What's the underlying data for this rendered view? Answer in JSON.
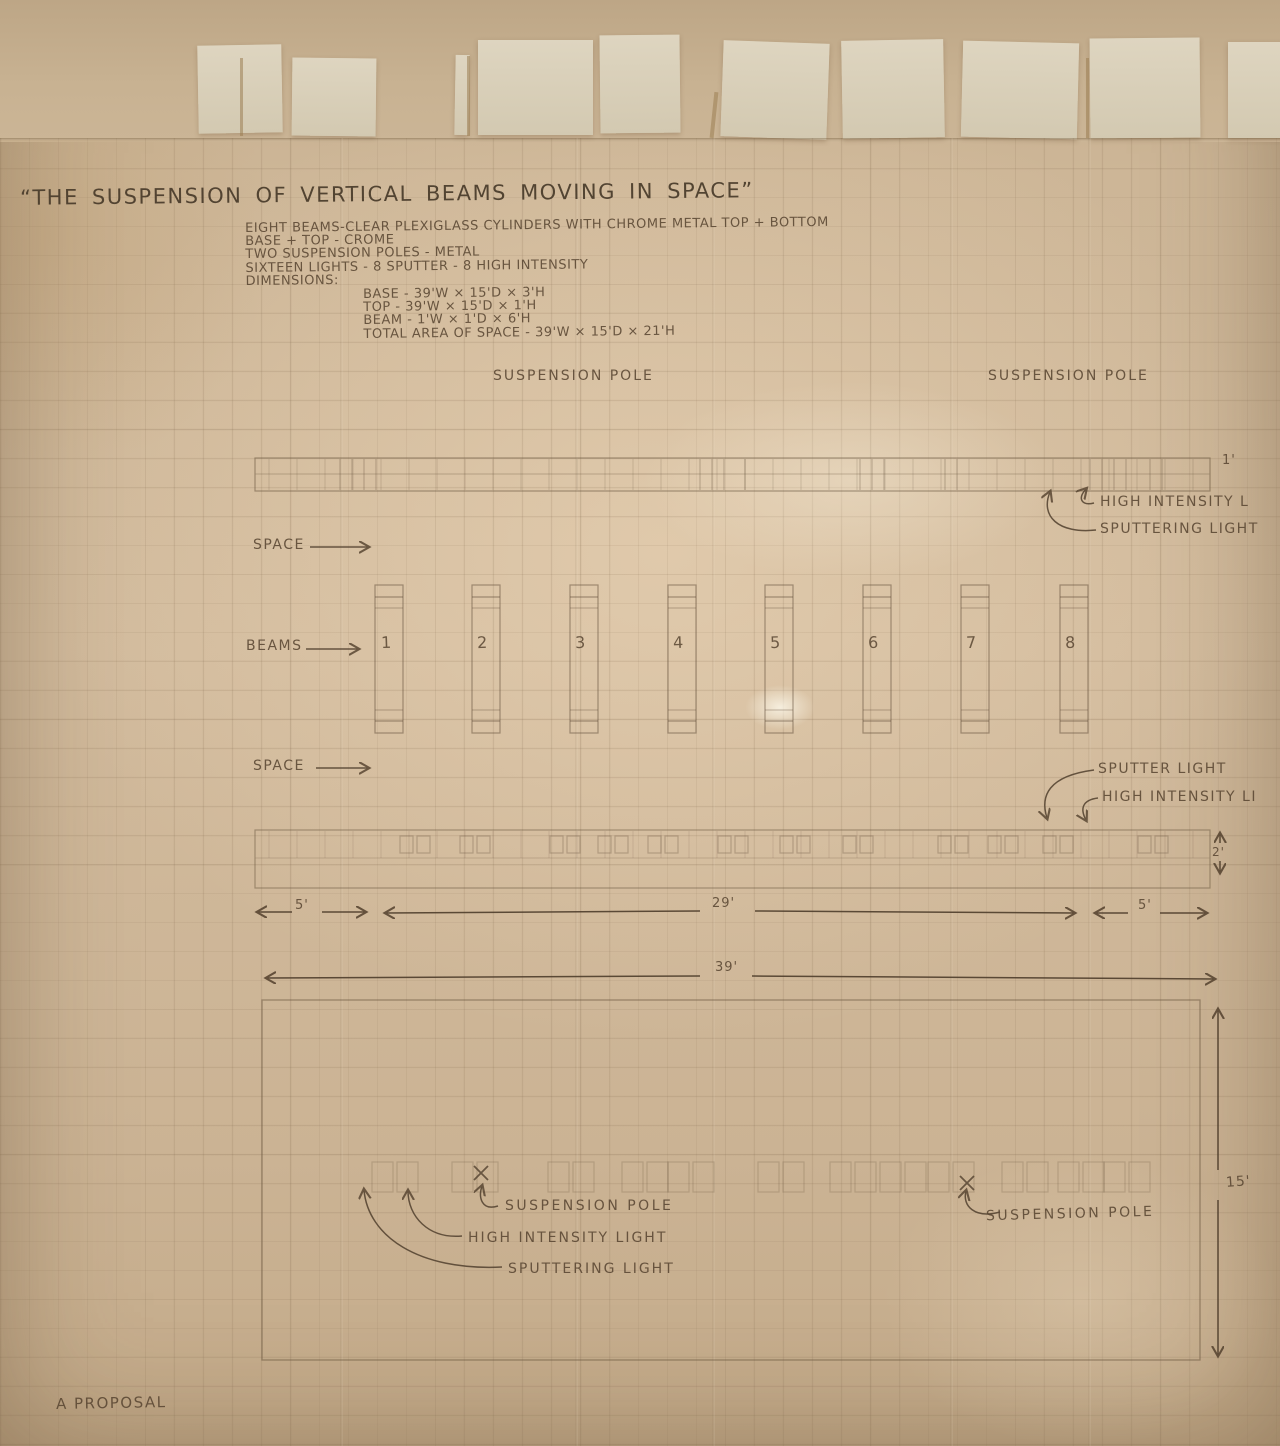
{
  "title": "“THE SUSPENSION OF VERTICAL BEAMS MOVING IN SPACE”",
  "specs": {
    "lines": [
      "EIGHT BEAMS-CLEAR PLEXIGLASS CYLINDERS WITH CHROME METAL TOP + BOTTOM",
      "BASE + TOP - CROME",
      "TWO SUSPENSION POLES - METAL",
      "SIXTEEN LIGHTS - 8 SPUTTER - 8 HIGH INTENSITY",
      "DIMENSIONS:"
    ],
    "dimension_lines": [
      "BASE - 39'W × 15'D × 3'H",
      "TOP  - 39'W × 15'D × 1'H",
      "BEAM - 1'W × 1'D × 6'H",
      "TOTAL AREA OF SPACE - 39'W × 15'D × 21'H"
    ]
  },
  "elevation": {
    "suspension_pole_left": "SUSPENSION POLE",
    "suspension_pole_right": "SUSPENSION POLE",
    "top_thickness": "1'",
    "high_intensity_top": "HIGH INTENSITY L",
    "sputtering_top": "SPUTTERING LIGHT",
    "space_upper": "SPACE",
    "beams_label": "BEAMS",
    "space_lower": "SPACE",
    "beam_numbers": [
      "1",
      "2",
      "3",
      "4",
      "5",
      "6",
      "7",
      "8"
    ],
    "sputter_mid": "SPUTTER LIGHT",
    "high_intensity_mid": "HIGH INTENSITY LI",
    "base_thickness": "2'",
    "dim_left": "5'",
    "dim_center": "29'",
    "dim_right": "5'"
  },
  "plan": {
    "width_dim": "39'",
    "depth_dim": "15'",
    "suspension_pole_left": "SUSPENSION POLE",
    "high_intensity": "HIGH INTENSITY LIGHT",
    "sputtering": "SPUTTERING LIGHT",
    "suspension_pole_right": "SUSPENSION POLE"
  },
  "footer": "A PROPOSAL",
  "colors": {
    "paper": "#cdb697",
    "pencil": "#5f4c37",
    "tab": "#d9d0ba"
  }
}
